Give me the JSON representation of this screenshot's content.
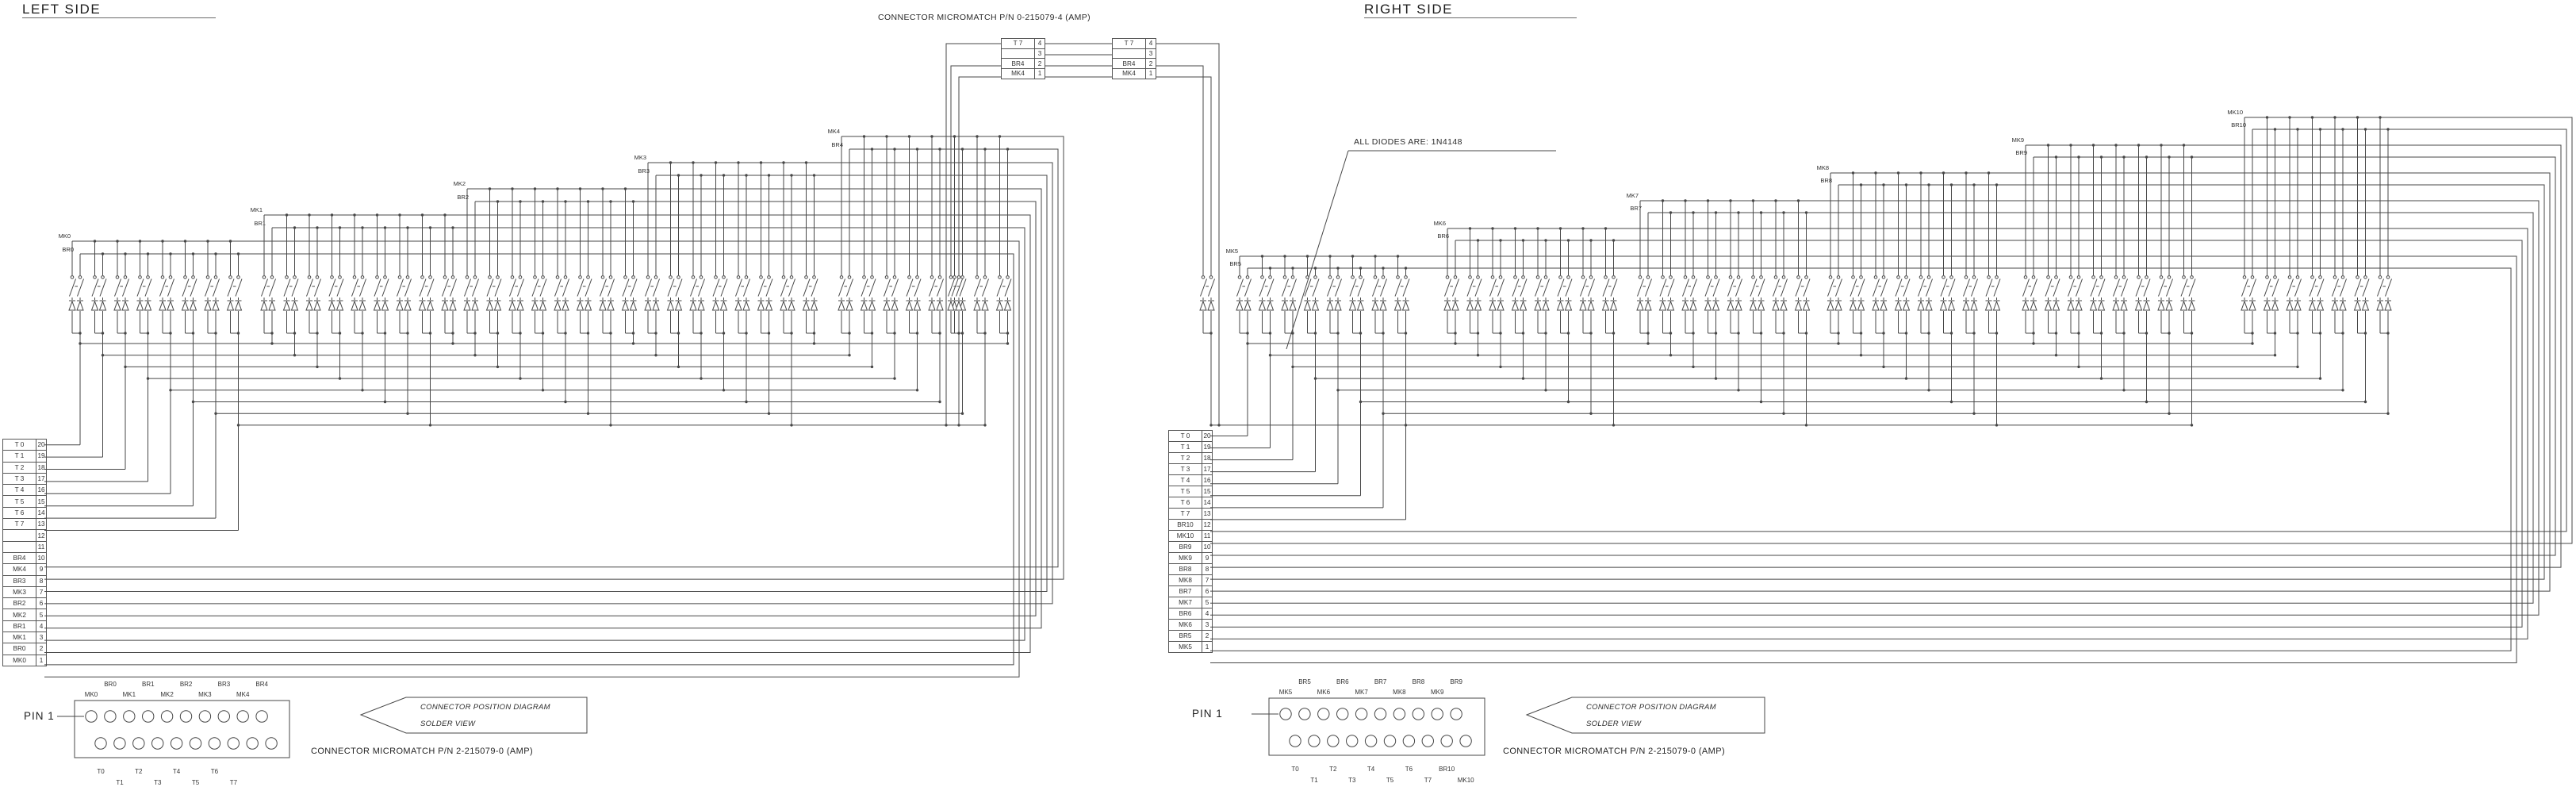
{
  "titles": {
    "left": "LEFT SIDE",
    "right": "RIGHT SIDE"
  },
  "link_connector": {
    "title": "CONNECTOR MICROMATCH P/N 0-215079-4 (AMP)",
    "left_table_rows": [
      [
        "T 7",
        "4"
      ],
      [
        "",
        "3"
      ],
      [
        "BR4",
        "2"
      ],
      [
        "MK4",
        "1"
      ]
    ],
    "right_table_rows": [
      [
        "T 7",
        "4"
      ],
      [
        "",
        "3"
      ],
      [
        "BR4",
        "2"
      ],
      [
        "MK4",
        "1"
      ]
    ]
  },
  "diodes_note": "ALL DIODES ARE: 1N4148",
  "left_side": {
    "matrix_groups": [
      {
        "mk": "MK0",
        "br": "BR0",
        "keys": 8
      },
      {
        "mk": "MK1",
        "br": "BR1",
        "keys": 9
      },
      {
        "mk": "MK2",
        "br": "BR2",
        "keys": 8
      },
      {
        "mk": "MK3",
        "br": "BR3",
        "keys": 8
      },
      {
        "mk": "MK4",
        "br": "BR4",
        "keys": 8
      }
    ],
    "pin_table_rows": [
      [
        "T 0",
        "20"
      ],
      [
        "T 1",
        "19"
      ],
      [
        "T 2",
        "18"
      ],
      [
        "T 3",
        "17"
      ],
      [
        "T 4",
        "16"
      ],
      [
        "T 5",
        "15"
      ],
      [
        "T 6",
        "14"
      ],
      [
        "T 7",
        "13"
      ],
      [
        "",
        "12"
      ],
      [
        "",
        "11"
      ],
      [
        "BR4",
        "10"
      ],
      [
        "MK4",
        "9"
      ],
      [
        "BR3",
        "8"
      ],
      [
        "MK3",
        "7"
      ],
      [
        "BR2",
        "6"
      ],
      [
        "MK2",
        "5"
      ],
      [
        "BR1",
        "4"
      ],
      [
        "MK1",
        "3"
      ],
      [
        "BR0",
        "2"
      ],
      [
        "MK0",
        "1"
      ]
    ]
  },
  "right_side": {
    "matrix_groups": [
      {
        "mk": "MK5",
        "br": "BR5",
        "keys": 8
      },
      {
        "mk": "MK6",
        "br": "BR6",
        "keys": 8
      },
      {
        "mk": "MK7",
        "br": "BR7",
        "keys": 8
      },
      {
        "mk": "MK8",
        "br": "BR8",
        "keys": 8
      },
      {
        "mk": "MK9",
        "br": "BR9",
        "keys": 8
      },
      {
        "mk": "MK10",
        "br": "BR10",
        "keys": 7
      }
    ],
    "pin_table_rows": [
      [
        "T 0",
        "20"
      ],
      [
        "T 1",
        "19"
      ],
      [
        "T 2",
        "18"
      ],
      [
        "T 3",
        "17"
      ],
      [
        "T 4",
        "16"
      ],
      [
        "T 5",
        "15"
      ],
      [
        "T 6",
        "14"
      ],
      [
        "T 7",
        "13"
      ],
      [
        "BR10",
        "12"
      ],
      [
        "MK10",
        "11"
      ],
      [
        "BR9",
        "10"
      ],
      [
        "MK9",
        "9"
      ],
      [
        "BR8",
        "8"
      ],
      [
        "MK8",
        "7"
      ],
      [
        "BR7",
        "6"
      ],
      [
        "MK7",
        "5"
      ],
      [
        "BR6",
        "4"
      ],
      [
        "MK6",
        "3"
      ],
      [
        "BR5",
        "2"
      ],
      [
        "MK5",
        "1"
      ]
    ]
  },
  "position_diagrams": {
    "pin1": "PIN 1",
    "callout_line1": "CONNECTOR POSITION DIAGRAM",
    "callout_line2": "SOLDER VIEW",
    "caption": "CONNECTOR MICROMATCH P/N 2-215079-0 (AMP)",
    "left": {
      "br_labels": [
        "BR0",
        "BR1",
        "BR2",
        "BR3",
        "BR4"
      ],
      "mk_labels": [
        "MK0",
        "MK1",
        "MK2",
        "MK3",
        "MK4"
      ],
      "bottom_even": [
        "T0",
        "T2",
        "T4",
        "T6"
      ],
      "bottom_odd": [
        "T1",
        "T3",
        "T5",
        "T7"
      ]
    },
    "right": {
      "br_labels": [
        "BR5",
        "BR6",
        "BR7",
        "BR8",
        "BR9"
      ],
      "mk_labels": [
        "MK5",
        "MK6",
        "MK7",
        "MK8",
        "MK9"
      ],
      "bottom_even": [
        "T0",
        "T2",
        "T4",
        "T6",
        "BR10"
      ],
      "bottom_odd": [
        "T1",
        "T3",
        "T5",
        "T7",
        "MK10"
      ]
    }
  },
  "colors": {
    "line": "#474747",
    "text": "#2e2e2e",
    "background": "#ffffff"
  }
}
